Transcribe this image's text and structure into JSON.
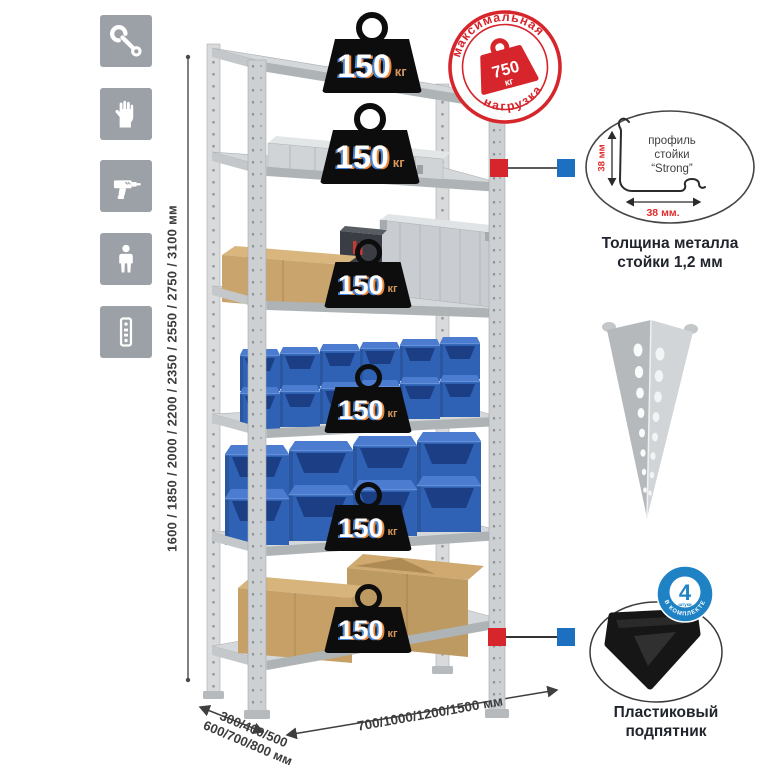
{
  "side_icons": [
    {
      "icon": "wrench-icon"
    },
    {
      "icon": "work-gloves-icon"
    },
    {
      "icon": "drill-icon"
    },
    {
      "icon": "person-icon"
    },
    {
      "icon": "perforated-profile-icon"
    }
  ],
  "height_dimension": {
    "label": "1600 / 1850 / 2000 / 2200 / 2350 / 2550 / 2750 / 3100 мм"
  },
  "depth_dimension": {
    "line1": "300/400/500",
    "line2": "600/700/800 мм"
  },
  "width_dimension": {
    "label": "700/1000/1200/1500 мм"
  },
  "stamp": {
    "text_top": "максимальная",
    "text_bottom": "нагрузка",
    "value": "750",
    "unit": "кг"
  },
  "rack": {
    "shelf_badges": [
      {
        "value": "150",
        "unit": "кг"
      },
      {
        "value": "150",
        "unit": "кг"
      },
      {
        "value": "150",
        "unit": "кг"
      },
      {
        "value": "150",
        "unit": "кг"
      },
      {
        "value": "150",
        "unit": "кг"
      },
      {
        "value": "150",
        "unit": "кг"
      }
    ]
  },
  "profile_feature": {
    "label_line1": "профиль",
    "label_line2": "стойки",
    "label_line3": "“Strong”",
    "height_dim": "38 мм",
    "width_dim": "38 мм.",
    "caption_line1": "Толщина металла",
    "caption_line2": "стойки 1,2 мм"
  },
  "foot_feature": {
    "badge_value": "4",
    "badge_small": "штуки",
    "badge_arc": "в комплекте",
    "caption_line1": "Пластиковый",
    "caption_line2": "подпятник"
  },
  "colors": {
    "stamp_red": "#d7252c",
    "accent_blue": "#1d6fc0",
    "badge_blue": "#1e82c5",
    "bin_blue": "#2f62b5",
    "icon_gray": "#9ba1a6",
    "metal_gray": "#d5d8da",
    "cardboard": "#c9a46d",
    "weight_black": "#0d0d0d",
    "kg_orange": "#d6975c"
  }
}
